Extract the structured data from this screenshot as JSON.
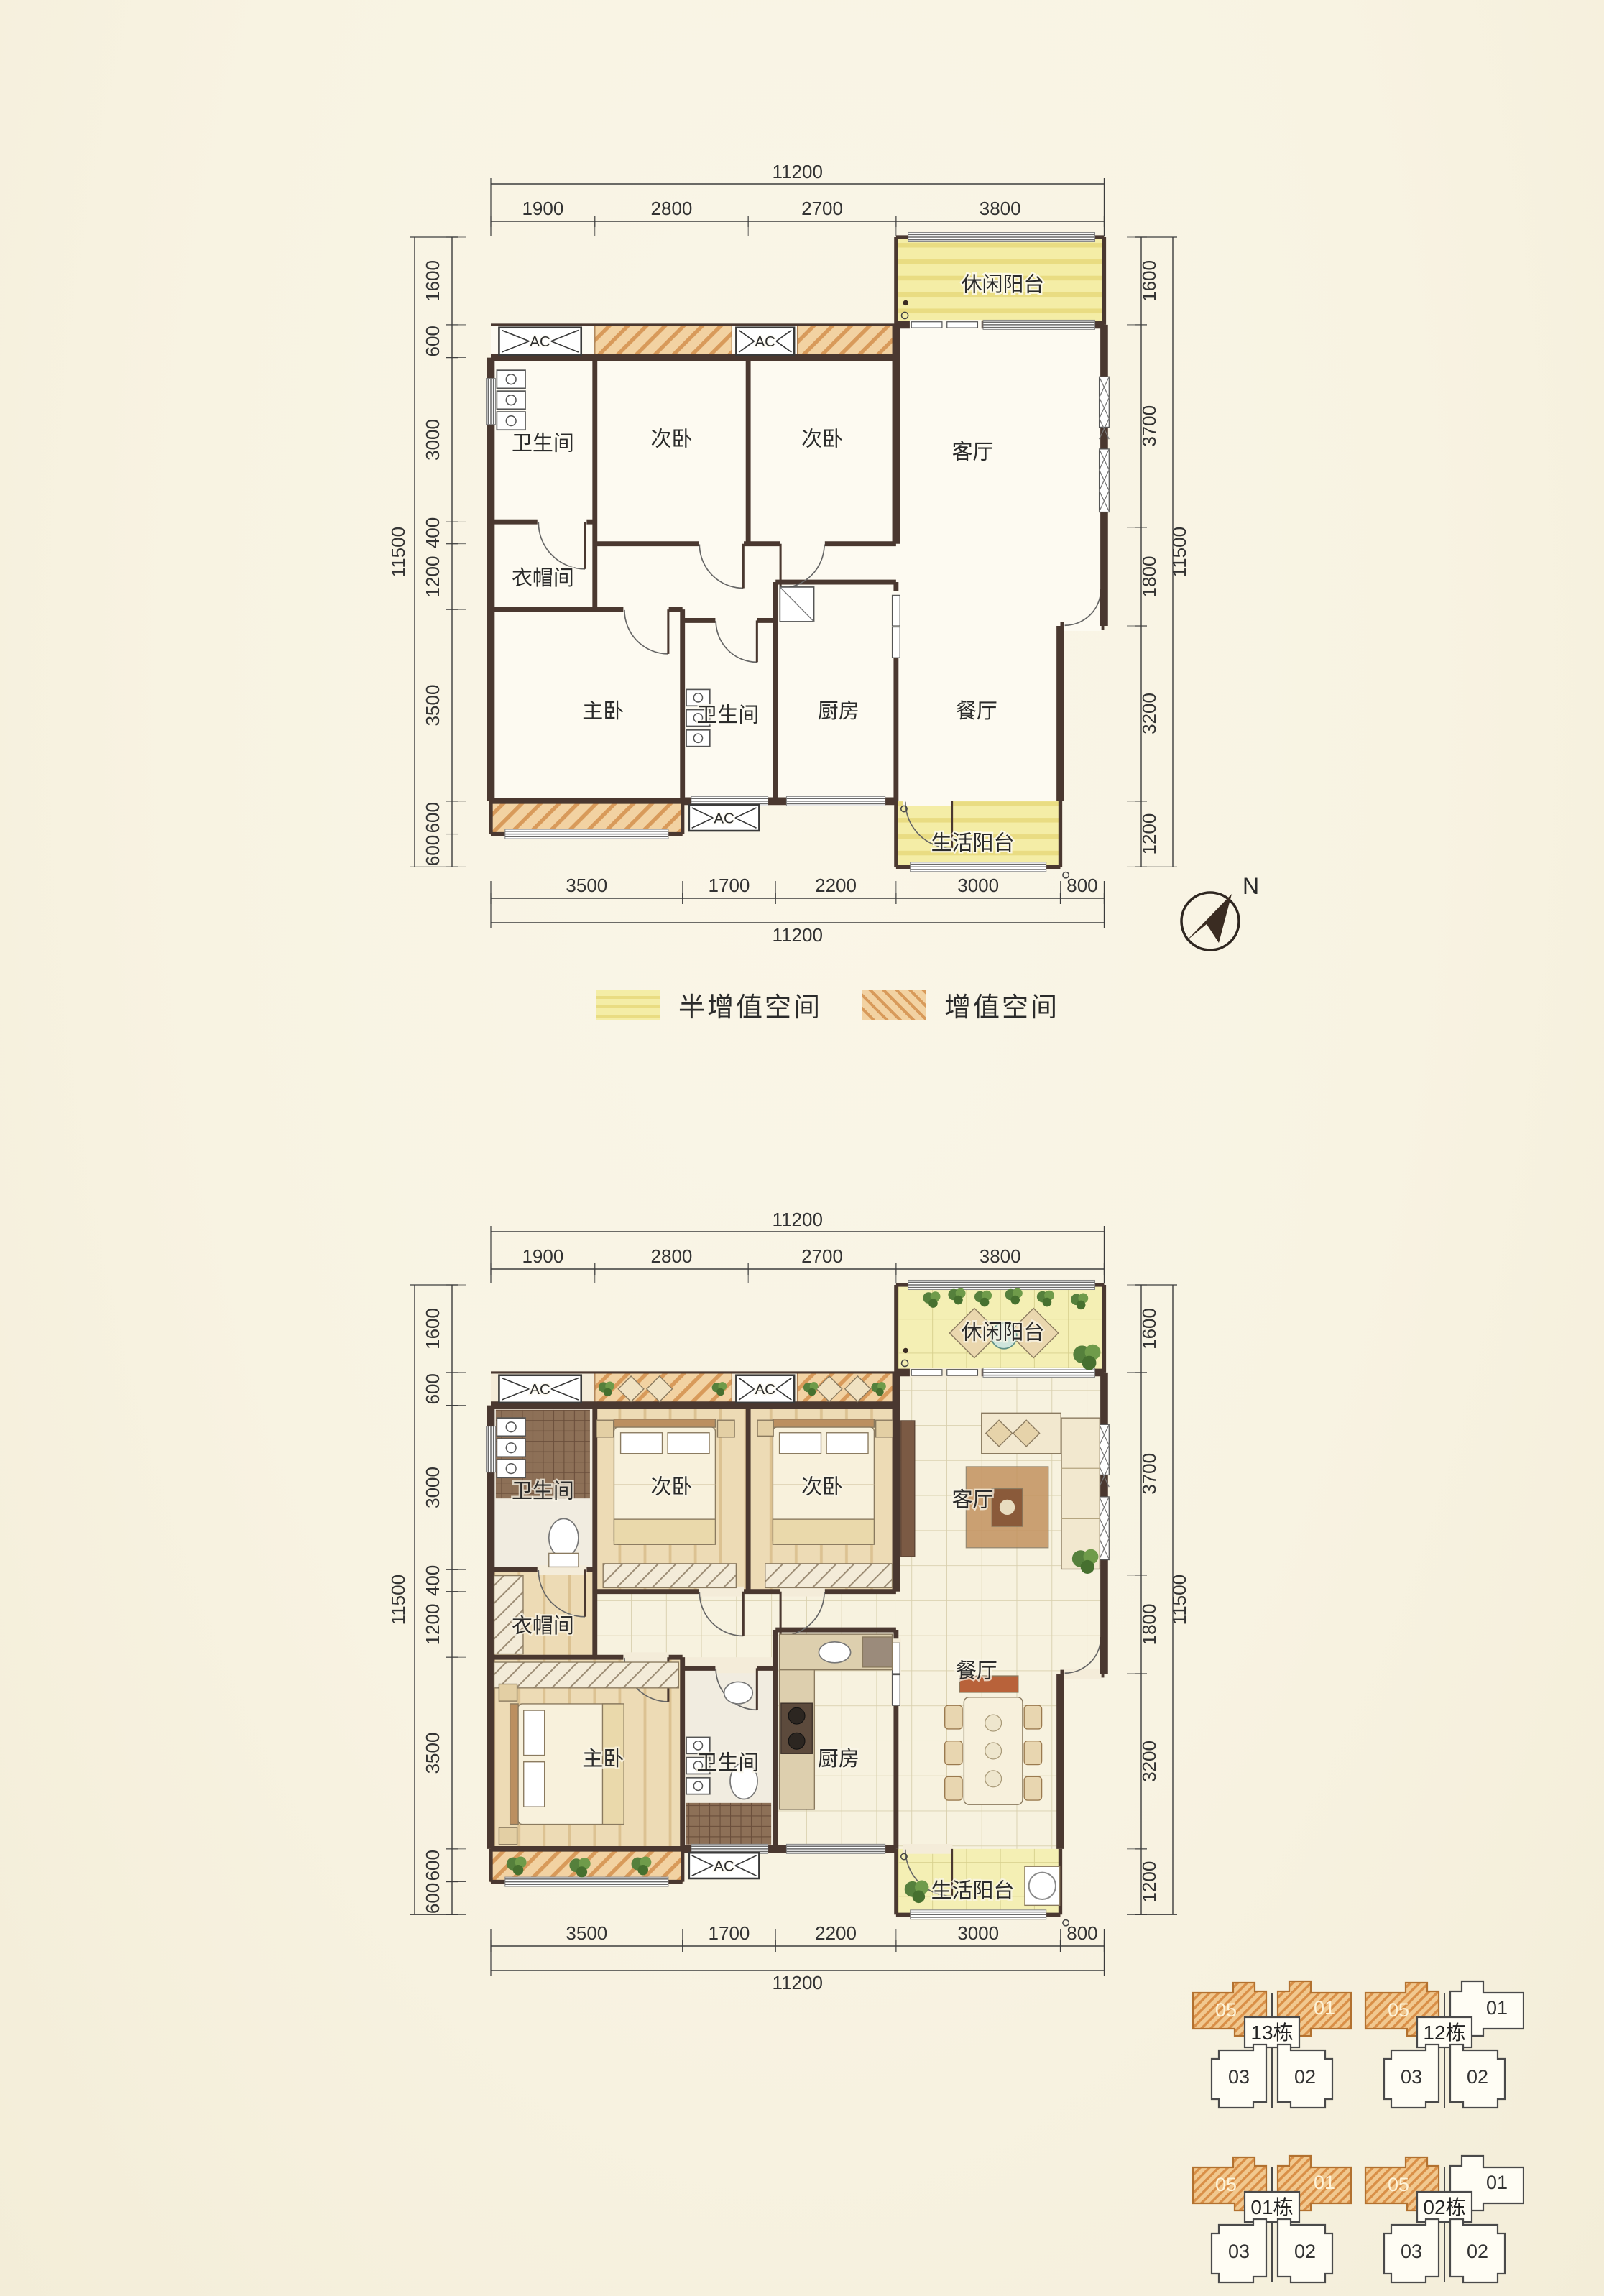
{
  "page": {
    "background": "#f8f3e2"
  },
  "plan": {
    "dims": {
      "top": {
        "total": "11200",
        "segments": [
          "1900",
          "2800",
          "2700",
          "3800"
        ]
      },
      "bottom": {
        "total": "11200",
        "segments": [
          "3500",
          "1700",
          "2200",
          "3000",
          "800"
        ]
      },
      "left": {
        "total": "11500",
        "segments": [
          "1600",
          "600",
          "3000",
          "400",
          "1200",
          "3500",
          "600",
          "600"
        ]
      },
      "right": {
        "total": "11500",
        "segments": [
          "1600",
          "3700",
          "1800",
          "3200",
          "1200"
        ]
      }
    },
    "rooms": {
      "leisure_balcony": "休闲阳台",
      "bathroom": "卫生间",
      "secondary_bedroom": "次卧",
      "living_room": "客厅",
      "cloakroom": "衣帽间",
      "master_bedroom": "主卧",
      "kitchen": "厨房",
      "dining_room": "餐厅",
      "utility_balcony": "生活阳台",
      "ac_unit": "AC"
    }
  },
  "legend": {
    "semi": {
      "label": "半增值空间",
      "fill": "#f4eda6",
      "stripe": "#e9dc82"
    },
    "value": {
      "label": "增值空间",
      "fill": "#f2d2a2",
      "stripe": "#d89a5a"
    }
  },
  "compass": {
    "label": "N"
  },
  "site_plans": [
    {
      "buildings": [
        {
          "name": "13栋",
          "top_units": [
            {
              "no": "05",
              "highlighted": true
            },
            {
              "no": "01",
              "highlighted": true
            }
          ],
          "bottom_units": [
            {
              "no": "03"
            },
            {
              "no": "02"
            }
          ]
        },
        {
          "name": "12栋",
          "top_units": [
            {
              "no": "05",
              "highlighted": true
            },
            {
              "no": "01",
              "highlighted": false
            }
          ],
          "bottom_units": [
            {
              "no": "03"
            },
            {
              "no": "02"
            }
          ]
        }
      ]
    },
    {
      "buildings": [
        {
          "name": "01栋",
          "top_units": [
            {
              "no": "05",
              "highlighted": true
            },
            {
              "no": "01",
              "highlighted": true
            }
          ],
          "bottom_units": [
            {
              "no": "03"
            },
            {
              "no": "02"
            }
          ]
        },
        {
          "name": "02栋",
          "top_units": [
            {
              "no": "05",
              "highlighted": true
            },
            {
              "no": "01",
              "highlighted": false
            }
          ],
          "bottom_units": [
            {
              "no": "03"
            },
            {
              "no": "02"
            }
          ]
        }
      ]
    }
  ]
}
